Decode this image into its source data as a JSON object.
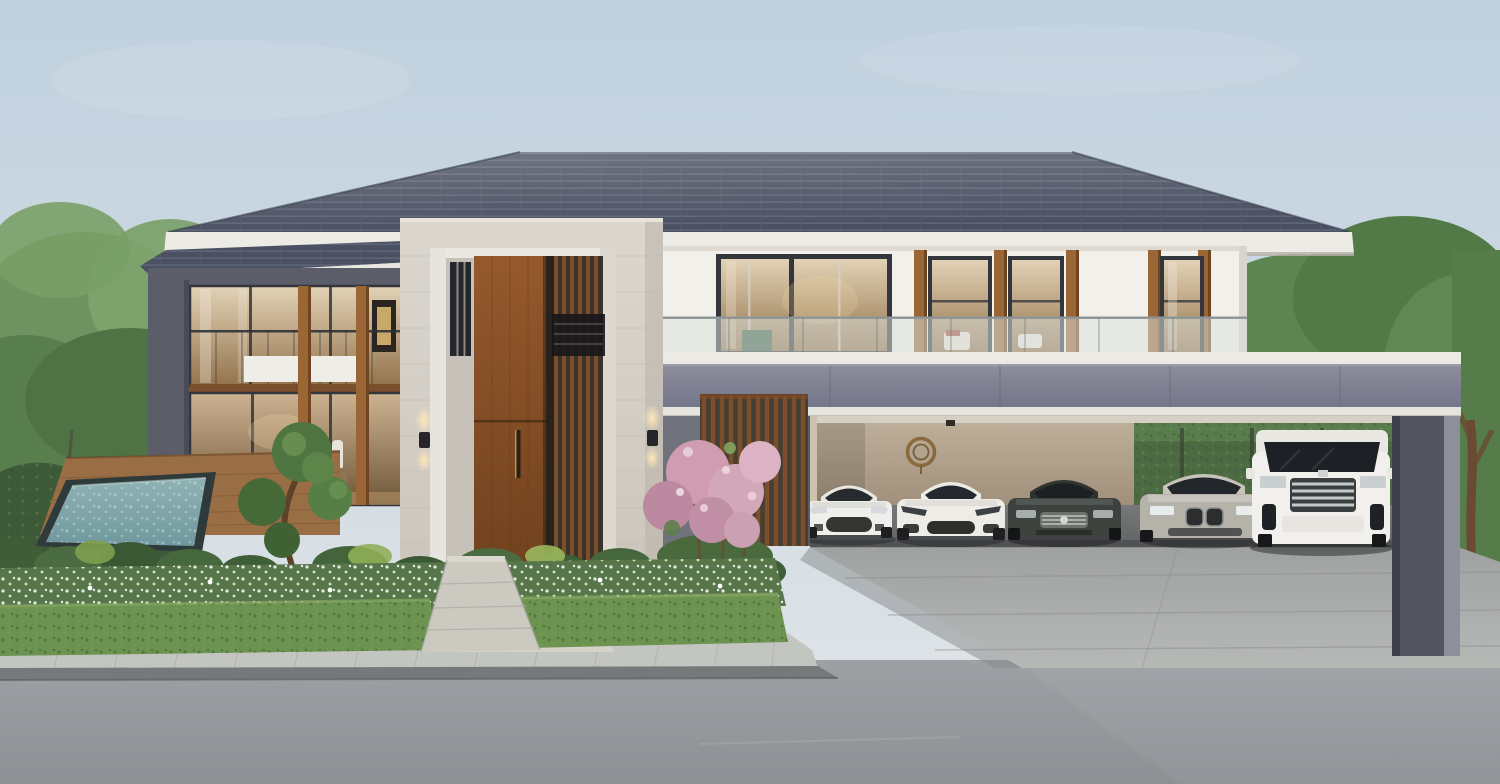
{
  "scene": {
    "kind": "architectural exterior photograph",
    "description": "Modern luxury two-storey detached house with large hip roof, marble entrance portal with tall wooden door, wood-slat screens, glass balustrade balcony, left wing with double-height glazing, swimming pool with timber deck, manicured front garden with topiary and pink flowering shrub, and a wide carport with five luxury cars, fronted by a sidewalk and asphalt road.",
    "sky": {
      "condition": "clear pale morning sky"
    },
    "house": {
      "storeys": 2,
      "roof": "dark slate hip roof with white fascia",
      "entrance": "stone portal, tall timber door, vertical slat screen, up-down wall lamps",
      "left_wing": "glass curtain wall with timber mullions and glass balcony",
      "upper_floor": "white wall, dark framed windows with warm interior light, glass balustrade"
    },
    "carport": {
      "fascia": "grey-violet band with white underside",
      "wall_ornament": "round bronze emblem",
      "cars": [
        {
          "name": "white-sports-coupe",
          "body": "#efeeea"
        },
        {
          "name": "white-grand-tourer",
          "body": "#edece7"
        },
        {
          "name": "dark-grey-sedan",
          "body": "#3d423f"
        },
        {
          "name": "silver-sports-sedan",
          "body": "#b5b2aa"
        },
        {
          "name": "white-luxury-minivan",
          "body": "#f1f0ec"
        }
      ]
    },
    "garden": {
      "features": [
        "swimming pool",
        "timber deck",
        "cloud-pruned topiary",
        "pink flowering shrub",
        "white flower bed",
        "clipped hedge",
        "ornamental grasses",
        "tall boundary hedge with trees"
      ]
    },
    "street": {
      "features": [
        "paved sidewalk",
        "dark curb",
        "asphalt road",
        "concrete driveway apron"
      ]
    }
  },
  "palette": {
    "sky_top": "#bfd0de",
    "sky_horizon": "#e2e6e8",
    "roof": "#4b5162",
    "roof_stripe": "#5e6577",
    "fascia_white": "#edebe5",
    "wall_white": "#f2f0ea",
    "slate_frame": "#5b5d68",
    "carport_fascia_top": "#8c8e9b",
    "carport_fascia_bottom": "#73758a",
    "carport_underside": "#e6e4de",
    "carport_wall_top": "#bdae9a",
    "carport_wall_bottom": "#9f8f7a",
    "carport_floor": "#636466",
    "stone_light": "#dcd7cf",
    "stone_dark": "#c9c3b9",
    "door_top": "#95592c",
    "door_bottom": "#6b3d1d",
    "slat_wood": "#7c4f2a",
    "mullion_wood": "#9a6636",
    "frame_dark": "#33363c",
    "glass_warm_top": "#e2d2b6",
    "glass_warm_bottom": "#93734c",
    "balustrade_glass": "#cfd8d2",
    "emblem_bronze": "#8a6a3c",
    "lamp_glow": "#ffe9b8",
    "hedge_dark": "#3e5a39",
    "hedge_front": "#6c9350",
    "foliage_mid": "#5d8551",
    "foliage_dark": "#4c6b43",
    "grass_accent": "#a9c465",
    "flower_pink": "#cf9cb0",
    "flower_bed_green": "#57764a",
    "pool_rim": "#2f3a3a",
    "pool_water_top": "#8fb2b4",
    "pool_water_bottom": "#6f989e",
    "deck_wood": "#9a6e44",
    "trunk_brown": "#6a4a33",
    "road_top": "#9da0a4",
    "road_bottom": "#8d9094",
    "sidewalk": "#c3c5c1",
    "curb": "#75797a",
    "driveway_top": "#9fa1a1",
    "driveway_bottom": "#b7b9b7"
  }
}
